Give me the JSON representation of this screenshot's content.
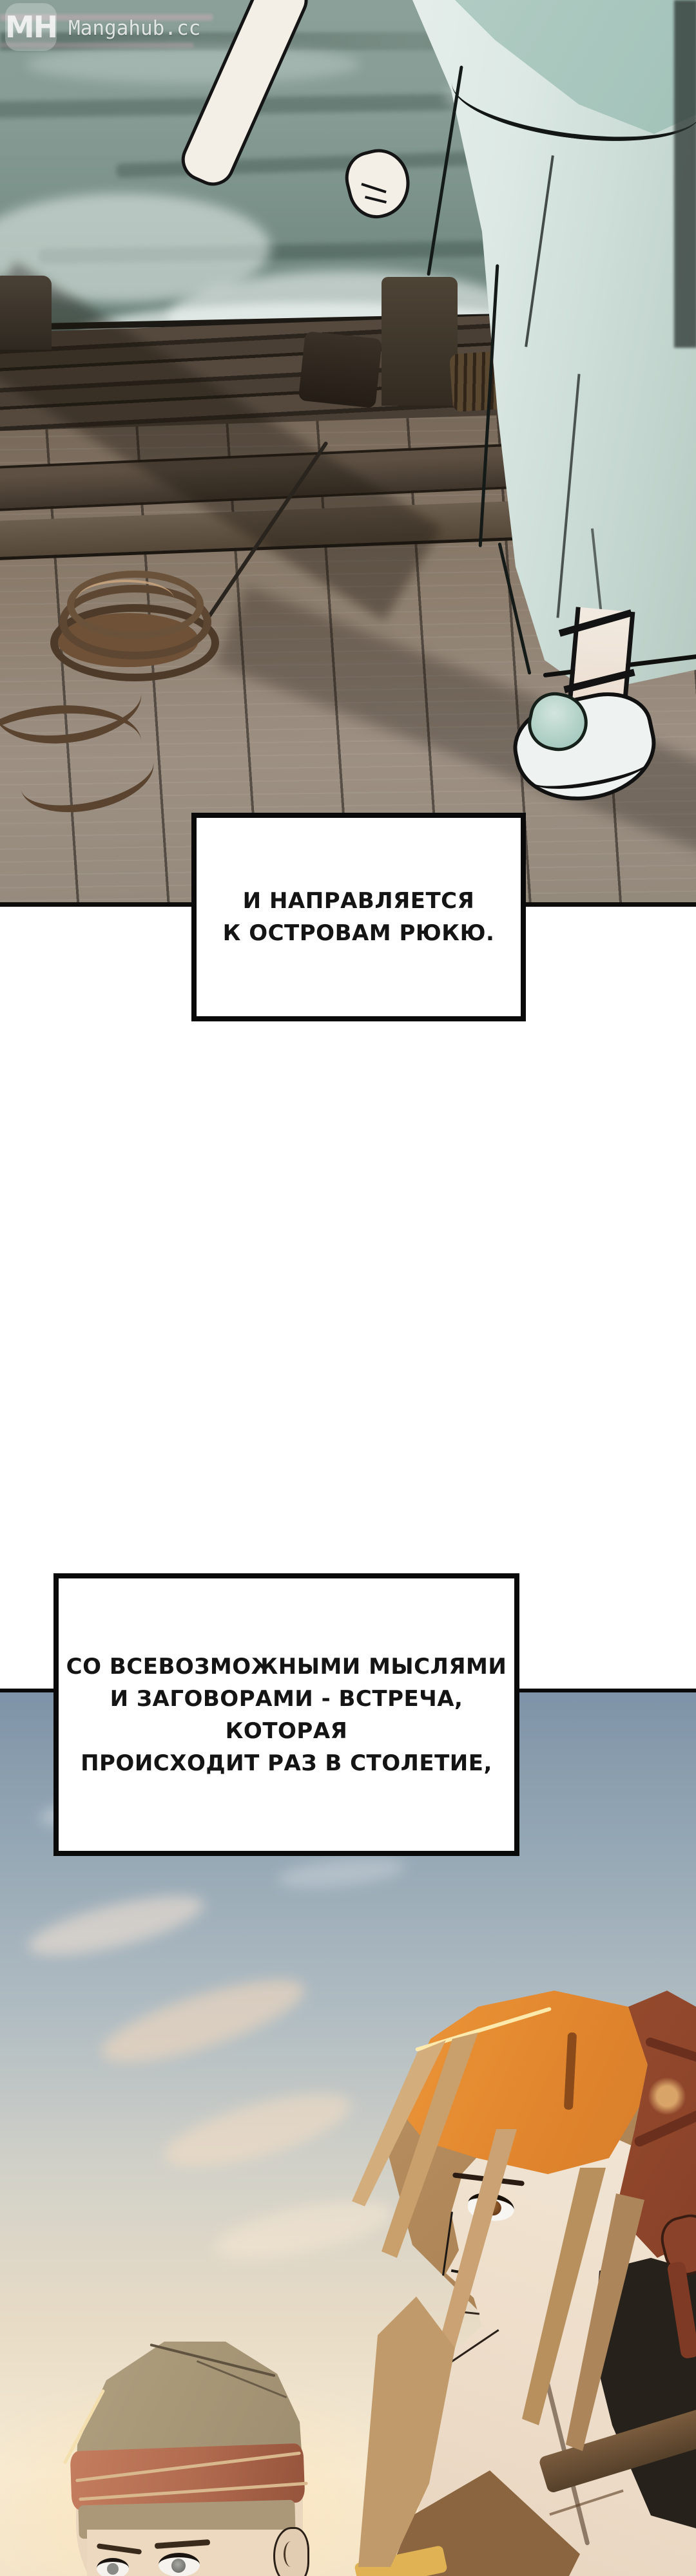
{
  "watermark": {
    "badge": "MH",
    "site": "Mangahub.cc"
  },
  "narration": {
    "box1": {
      "lines": [
        "И НАПРАВЛЯЕТСЯ",
        "К ОСТРОВАМ РЮКЮ."
      ]
    },
    "box2": {
      "lines": [
        "СО ВСЕВОЗМОЖНЫМИ МЫСЛЯМИ",
        "И ЗАГОВОРАМИ - ВСТРЕЧА, КОТОРАЯ",
        "ПРОИСХОДИТ РАЗ В СТОЛЕТИЕ,"
      ]
    }
  },
  "scenes": {
    "dock": {
      "description": "figure in pale robe standing on wooden pier by stormy sea"
    },
    "sunset": {
      "description": "two characters in bandanas against sunset sky"
    }
  },
  "colors": {
    "water": "#7b928a",
    "foam": "#f2f7f5",
    "dock_wood": "#8d7e6e",
    "robe": "#e9f0ed",
    "robe_sash": "#9fc0b6",
    "rope": "#5d4732",
    "sky_top": "#7e93a7",
    "sky_warm": "#f6ecd8",
    "bandana_orange": "#f4a648",
    "bandana_red_back": "#9c4f30",
    "hair_brown": "#c9a272",
    "cap_tan": "#a89878",
    "cap_band_red": "#b06a4e",
    "narration_bg": "#ffffff",
    "narration_border": "#0a0a0a"
  }
}
